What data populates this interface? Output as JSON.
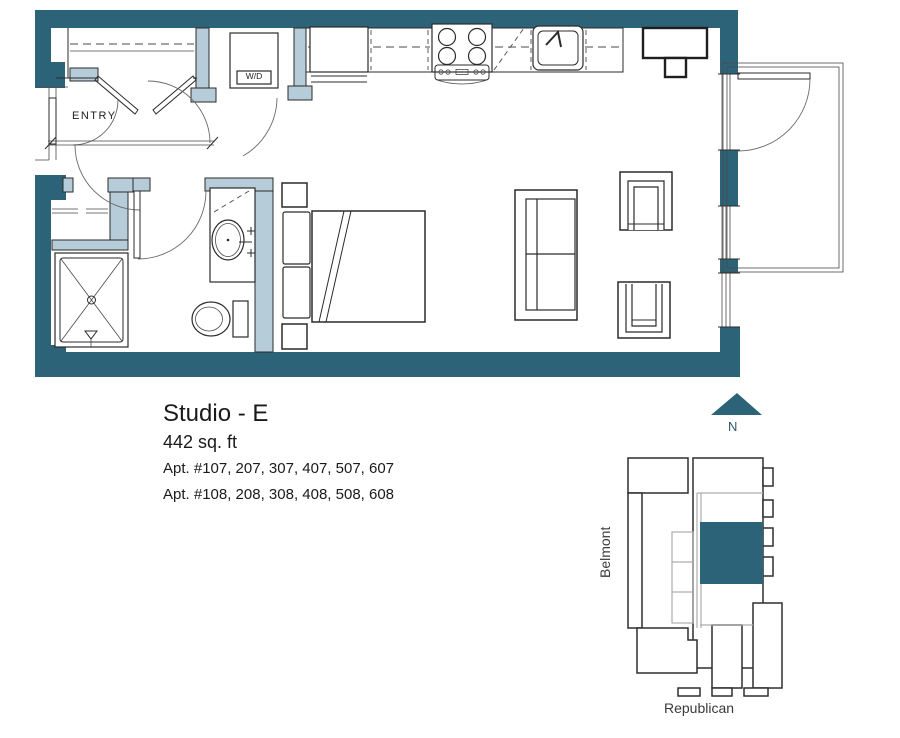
{
  "plan": {
    "title": "Studio - E",
    "area": "442 sq. ft",
    "apartments_line1": "Apt. #107, 207, 307, 407, 507, 607",
    "apartments_line2": "Apt. #108, 208, 308, 408, 508, 608",
    "labels": {
      "entry": "ENTRY",
      "washer_dryer": "W/D"
    },
    "rooms_and_fixtures": [
      "entry closet with bifold doors",
      "washer-dryer closet",
      "kitchen with refrigerator, stove, dishwasher, sink",
      "bathroom with vanity sink, toilet, shower",
      "bed with two pillows and nightstands",
      "sofa",
      "two armchairs",
      "table with stool",
      "balcony"
    ]
  },
  "compass": {
    "label": "N",
    "direction": "up"
  },
  "site_map": {
    "street_left": "Belmont",
    "street_bottom": "Republican",
    "highlighted_unit_color": "#2d6378"
  },
  "colors": {
    "wall_teal": "#2d6378",
    "wall_light_blue": "#b7ccd9",
    "line": "#2b2b2b",
    "text": "#1a1a1a"
  }
}
